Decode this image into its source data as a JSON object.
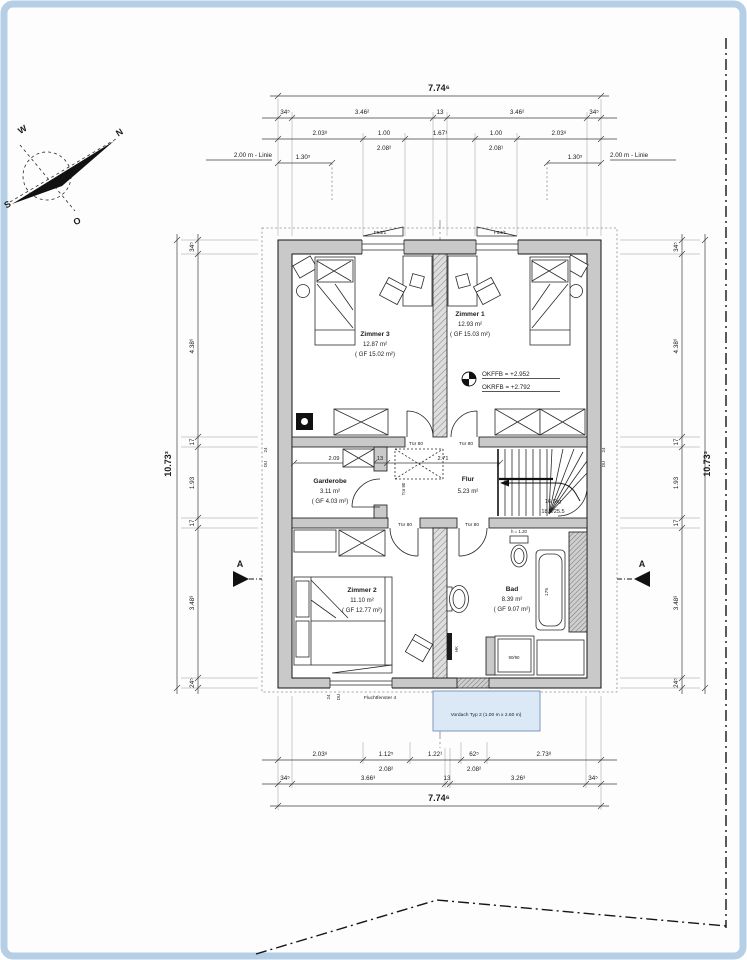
{
  "colors": {
    "frame": "#b5cfe6",
    "wall": "#c9c9c9",
    "vordach-fill": "#dbe8f5",
    "vordach-border": "#7e99c0",
    "vordach-text": "#17365d"
  },
  "compass": {
    "n": "N",
    "e": "O",
    "s": "S",
    "w": "W"
  },
  "dims": {
    "top": {
      "overall": "7.74⁶",
      "row2": [
        "34⁵",
        "3.46²",
        "13",
        "3.46²",
        "34⁵"
      ],
      "row3": [
        "2.03⁸",
        "1.00",
        "1.67¹",
        "1.00",
        "2.03⁸"
      ],
      "row3_sub": [
        "2.08²",
        "2.08¹"
      ],
      "linie": "2.00 m - Linie",
      "offset": "1.30⁵"
    },
    "bottom": {
      "overall": "7.74⁶",
      "row1": [
        "2.03⁸",
        "1.12⁵",
        "1.22¹",
        "62⁵",
        "2.73⁸"
      ],
      "row1_sub": [
        "2.08²",
        "2.08²"
      ],
      "row2": [
        "34⁵",
        "3.66³",
        "13",
        "3.26³",
        "34⁵"
      ]
    },
    "side": {
      "overall": "10.73³",
      "chain": [
        "34⁵",
        "4.38⁶",
        "17",
        "1.93",
        "17",
        "3.48³",
        "24⁵"
      ]
    },
    "garderobe_chain": [
      "2.09",
      "13",
      "2.71"
    ],
    "small": {
      "d24": "24",
      "du": "DU"
    }
  },
  "rooms": {
    "zimmer3": {
      "name": "Zimmer 3",
      "area": "12.87 m²",
      "gf": "( GF 15.02 m²)"
    },
    "zimmer1": {
      "name": "Zimmer 1",
      "area": "12.93 m²",
      "gf": "( GF 15.03 m²)"
    },
    "zimmer2": {
      "name": "Zimmer 2",
      "area": "11.10 m²",
      "gf": "( GF 12.77 m²)"
    },
    "bad": {
      "name": "Bad",
      "area": "8.39 m²",
      "gf": "( GF 9.07 m²)"
    },
    "garderobe": {
      "name": "Garderobe",
      "area": "3.11 m²",
      "gf": "( GF 4.03 m²)"
    },
    "flur": {
      "name": "Flur",
      "area": "5.23 m²"
    }
  },
  "stairs": {
    "line1": "16 Stg",
    "line2": "18.5/25.5"
  },
  "levels": {
    "okffb": "OKFFB = +2.952",
    "okrfb": "OKRFB = +2.792"
  },
  "openings": {
    "f53": "F53/1",
    "f54": "F54/1",
    "flucht": "Fluchtfenster 4",
    "f60": "F60/1"
  },
  "fixtures": {
    "tub": "175",
    "shower": "90/90",
    "wc_h": "h = 1.20",
    "hk": "HK"
  },
  "vordach_label": "Vordach Typ 2 (1.00 m x 2.60 m)",
  "door_label": "Tür 80",
  "section_label": "A"
}
